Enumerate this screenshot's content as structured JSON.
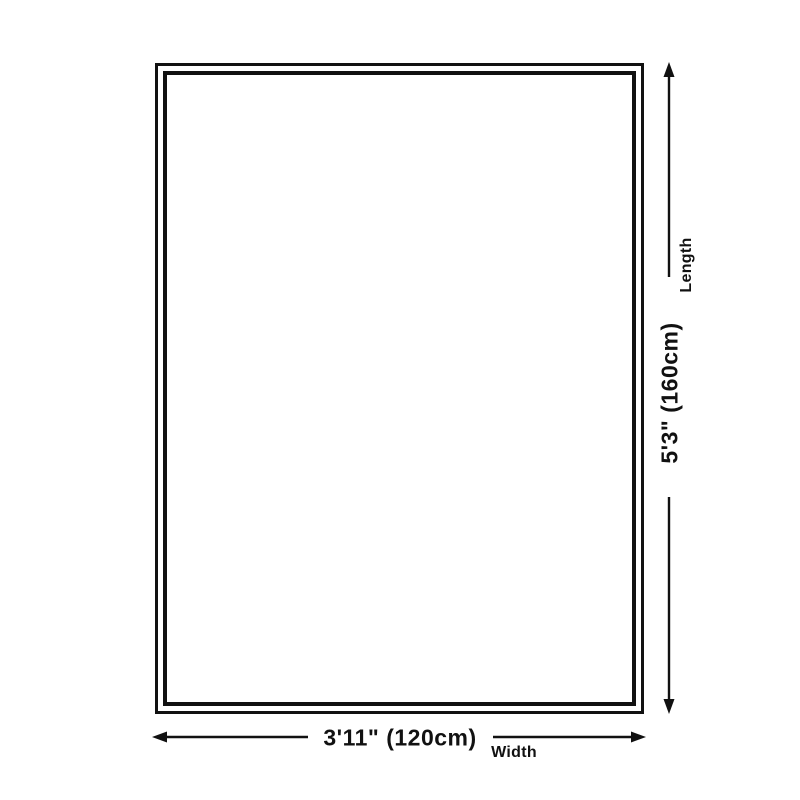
{
  "diagram": {
    "length": {
      "label": "Length",
      "value": "5'3\" (160cm)"
    },
    "width": {
      "label": "Width",
      "value": "3'11\" (120cm)"
    }
  },
  "colors": {
    "line": "#111111",
    "background": "#ffffff"
  }
}
